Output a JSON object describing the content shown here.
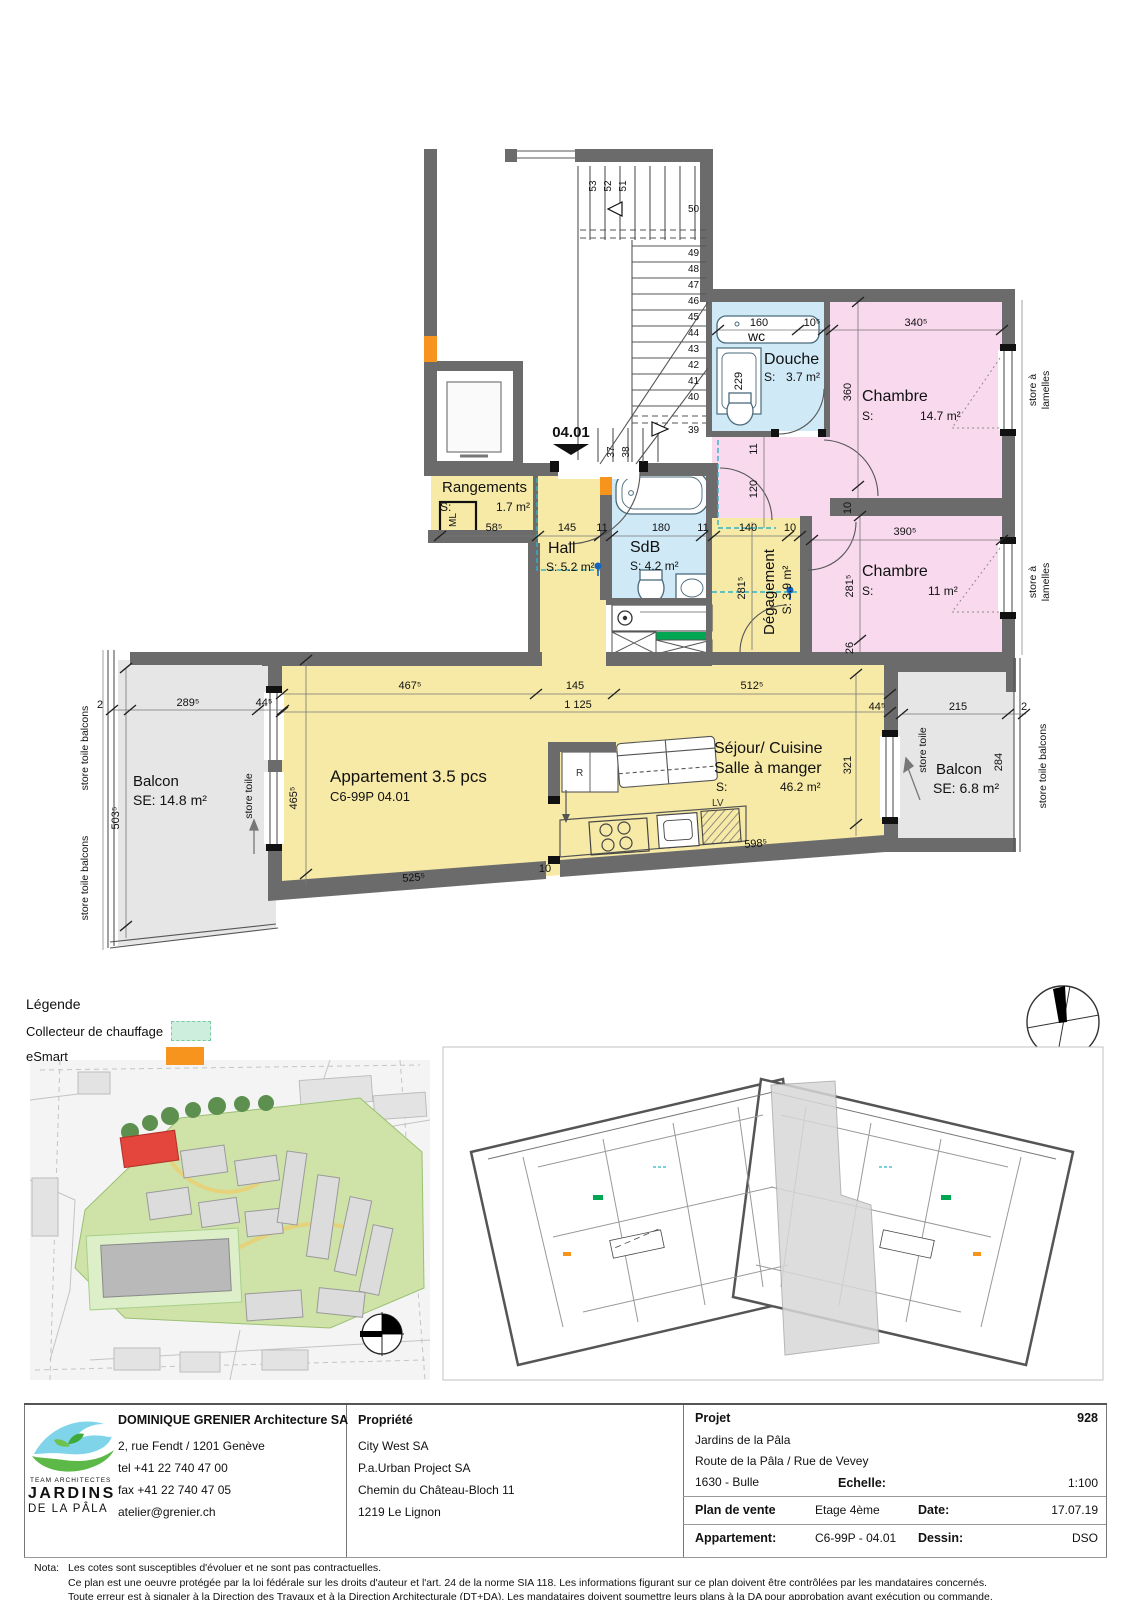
{
  "plan": {
    "unit": "04.01",
    "apartment_type": "Appartement 3.5 pcs",
    "apartment_code": "C6-99P 04.01",
    "rooms": {
      "rangements": {
        "name": "Rangements",
        "s": "S:",
        "area": "1.7 m²"
      },
      "hall": {
        "name": "Hall",
        "area": "S: 5.2 m²"
      },
      "sdb": {
        "name": "SdB",
        "area": "S: 4.2 m²"
      },
      "wc": {
        "name": "wc"
      },
      "douche": {
        "name": "Douche",
        "s": "S:",
        "area": "3.7 m²"
      },
      "chambre1": {
        "name": "Chambre",
        "s": "S:",
        "area": "14.7 m²"
      },
      "chambre2": {
        "name": "Chambre",
        "s": "S:",
        "area": "11 m²"
      },
      "degagement": {
        "name": "Dégagement",
        "area": "S:  3.9 m²"
      },
      "sejour": {
        "line1": "Séjour/ Cuisine",
        "line2": "Salle à manger",
        "s": "S:",
        "area": "46.2 m²"
      },
      "balcon_left": {
        "name": "Balcon",
        "area": "SE: 14.8 m²"
      },
      "balcon_right": {
        "name": "Balcon",
        "area": "SE: 6.8 m²"
      }
    },
    "labels": {
      "ml": "ML",
      "lv": "LV",
      "r": "R",
      "store_a": "store à",
      "lamelles": "lamelles",
      "store_toile": "store toile",
      "store_toile_balcons": "store toile balcons"
    },
    "stairs": [
      "37",
      "38",
      "39",
      "40",
      "41",
      "42",
      "43",
      "44",
      "45",
      "46",
      "47",
      "48",
      "49",
      "50",
      "51",
      "52",
      "53"
    ],
    "dims": {
      "d160": "160",
      "d105": "10⁵",
      "d3405": "340⁵",
      "d229": "229",
      "d360": "360",
      "d11rot": "11",
      "d120": "120",
      "d10rot": "10",
      "d3905": "390⁵",
      "d2815deg": "281⁵",
      "d2815ch": "281⁵",
      "d26": "26",
      "d140": "140",
      "d10deg": "10",
      "d585": "58⁵",
      "d145sdb": "145",
      "d11a": "11",
      "d180": "180",
      "d11b": "11",
      "d4675": "467⁵",
      "d145sej": "145",
      "d5125": "512⁵",
      "d1125": "1 125",
      "d4655": "465⁵",
      "d5255": "525⁵",
      "d10sej": "10",
      "d5985": "598⁵",
      "d445r": "44⁵",
      "d321": "321",
      "d2895": "289⁵",
      "d445l": "44⁵",
      "d2l": "2",
      "d5035": "503⁵",
      "d215": "215",
      "d2r": "2",
      "d284": "284"
    },
    "colors": {
      "wall": "#6b6b6b",
      "living": "#f6eaa6",
      "bedroom": "#f9d9ee",
      "bath": "#cfe9f6",
      "balcony": "#e6e6e6",
      "collector": "#00a651",
      "esmart": "#f7941e"
    }
  },
  "legend": {
    "title": "Légende",
    "collecteur": "Collecteur de chauffage",
    "esmart": "eSmart",
    "collecteur_color": "#cdeedd",
    "esmart_color": "#f7941e"
  },
  "titleblock": {
    "architect": {
      "name": "DOMINIQUE GRENIER Architecture SA",
      "address": "2, rue Fendt / 1201 Genève",
      "tel": "tel +41 22 740 47 00",
      "fax": "fax +41 22 740 47 05",
      "email": "atelier@grenier.ch",
      "logo_line1": "TEAM ARCHITECTES",
      "logo_line2": "JARDINS",
      "logo_line3": "DE LA PÂLA"
    },
    "owner": {
      "title": "Propriété",
      "line1": "City West SA",
      "line2": "P.a.Urban Project SA",
      "line3": "Chemin du Château-Bloch 11",
      "line4": "1219 Le Lignon"
    },
    "project": {
      "title": "Projet",
      "number": "928",
      "line1": "Jardins de la Pâla",
      "line2": "Route de la Pâla / Rue de Vevey",
      "line3": "1630 - Bulle"
    },
    "meta": {
      "echelle_label": "Echelle:",
      "echelle": "1:100",
      "plan_label": "Plan de vente",
      "etage": "Etage 4ème",
      "date_label": "Date:",
      "date": "17.07.19",
      "appartement_label": "Appartement:",
      "appartement": "C6-99P - 04.01",
      "dessin_label": "Dessin:",
      "dessin": "DSO"
    }
  },
  "nota": {
    "label": "Nota:",
    "line1": "Les cotes sont susceptibles d'évoluer et ne sont pas contractuelles.",
    "line2": "Ce plan est une oeuvre protégée par la loi fédérale sur les droits d'auteur et l'art. 24 de la norme SIA 118. Les informations figurant sur ce plan doivent être contrôlées par les mandataires concernés.",
    "line3": "Toute erreur est à signaler à la Direction des Travaux et à la Direction Architecturale (DT+DA). Les mandataires doivent soumettre leurs plans à la DA pour approbation avant exécution ou commande."
  }
}
